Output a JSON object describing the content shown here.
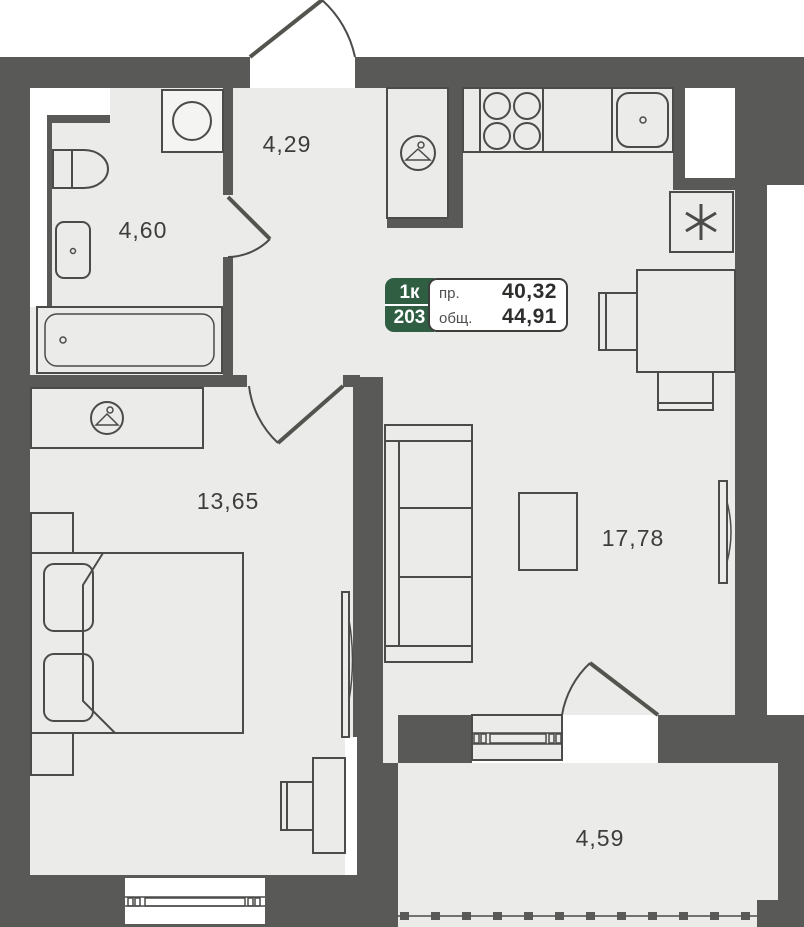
{
  "unit_card": {
    "type_label": "1к",
    "unit_number": "203",
    "area_living_label": "пр.",
    "area_living_value": "40,32",
    "area_total_label": "общ.",
    "area_total_value": "44,91"
  },
  "rooms": {
    "bathroom_area": "4,60",
    "hallway_area": "4,29",
    "bedroom_area": "13,65",
    "living_kitchen_area": "17,78",
    "balcony_area": "4,59"
  },
  "icons": {
    "hallway_closet": "hanger-icon",
    "bedroom_wardrobe": "hanger-icon",
    "fridge": "asterisk-icon"
  },
  "colors": {
    "wall": "#595957",
    "floor": "#ebebea",
    "stroke": "#4b4b49",
    "accent_green": "#2f5e43",
    "label_text": "#3d3d3c"
  }
}
